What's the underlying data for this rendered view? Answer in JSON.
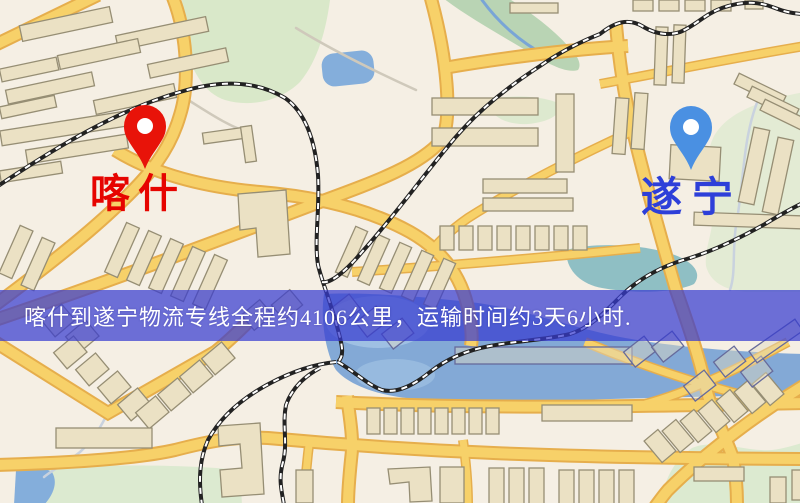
{
  "pins": {
    "origin": {
      "label": "喀什",
      "pin_color": "#e81309",
      "label_color": "#e60400"
    },
    "destination": {
      "label": "遂宁",
      "pin_color": "#4a90e2",
      "label_color": "#2d3fd9"
    }
  },
  "banner": {
    "text": "喀什到遂宁物流专线全程约4106公里，运输时间约3天6小时.",
    "background_color": "rgba(56,60,208,0.72)",
    "text_color": "#ffffff"
  },
  "map_colors": {
    "background": "#f5efe4",
    "road_fill": "#f7d169",
    "road_casing": "#e6ae4c",
    "water": "#83a9d6",
    "park_green": "#d9e8c9",
    "building_fill": "#ebe1c4",
    "building_outline": "#968e74",
    "railway": "#222222"
  }
}
